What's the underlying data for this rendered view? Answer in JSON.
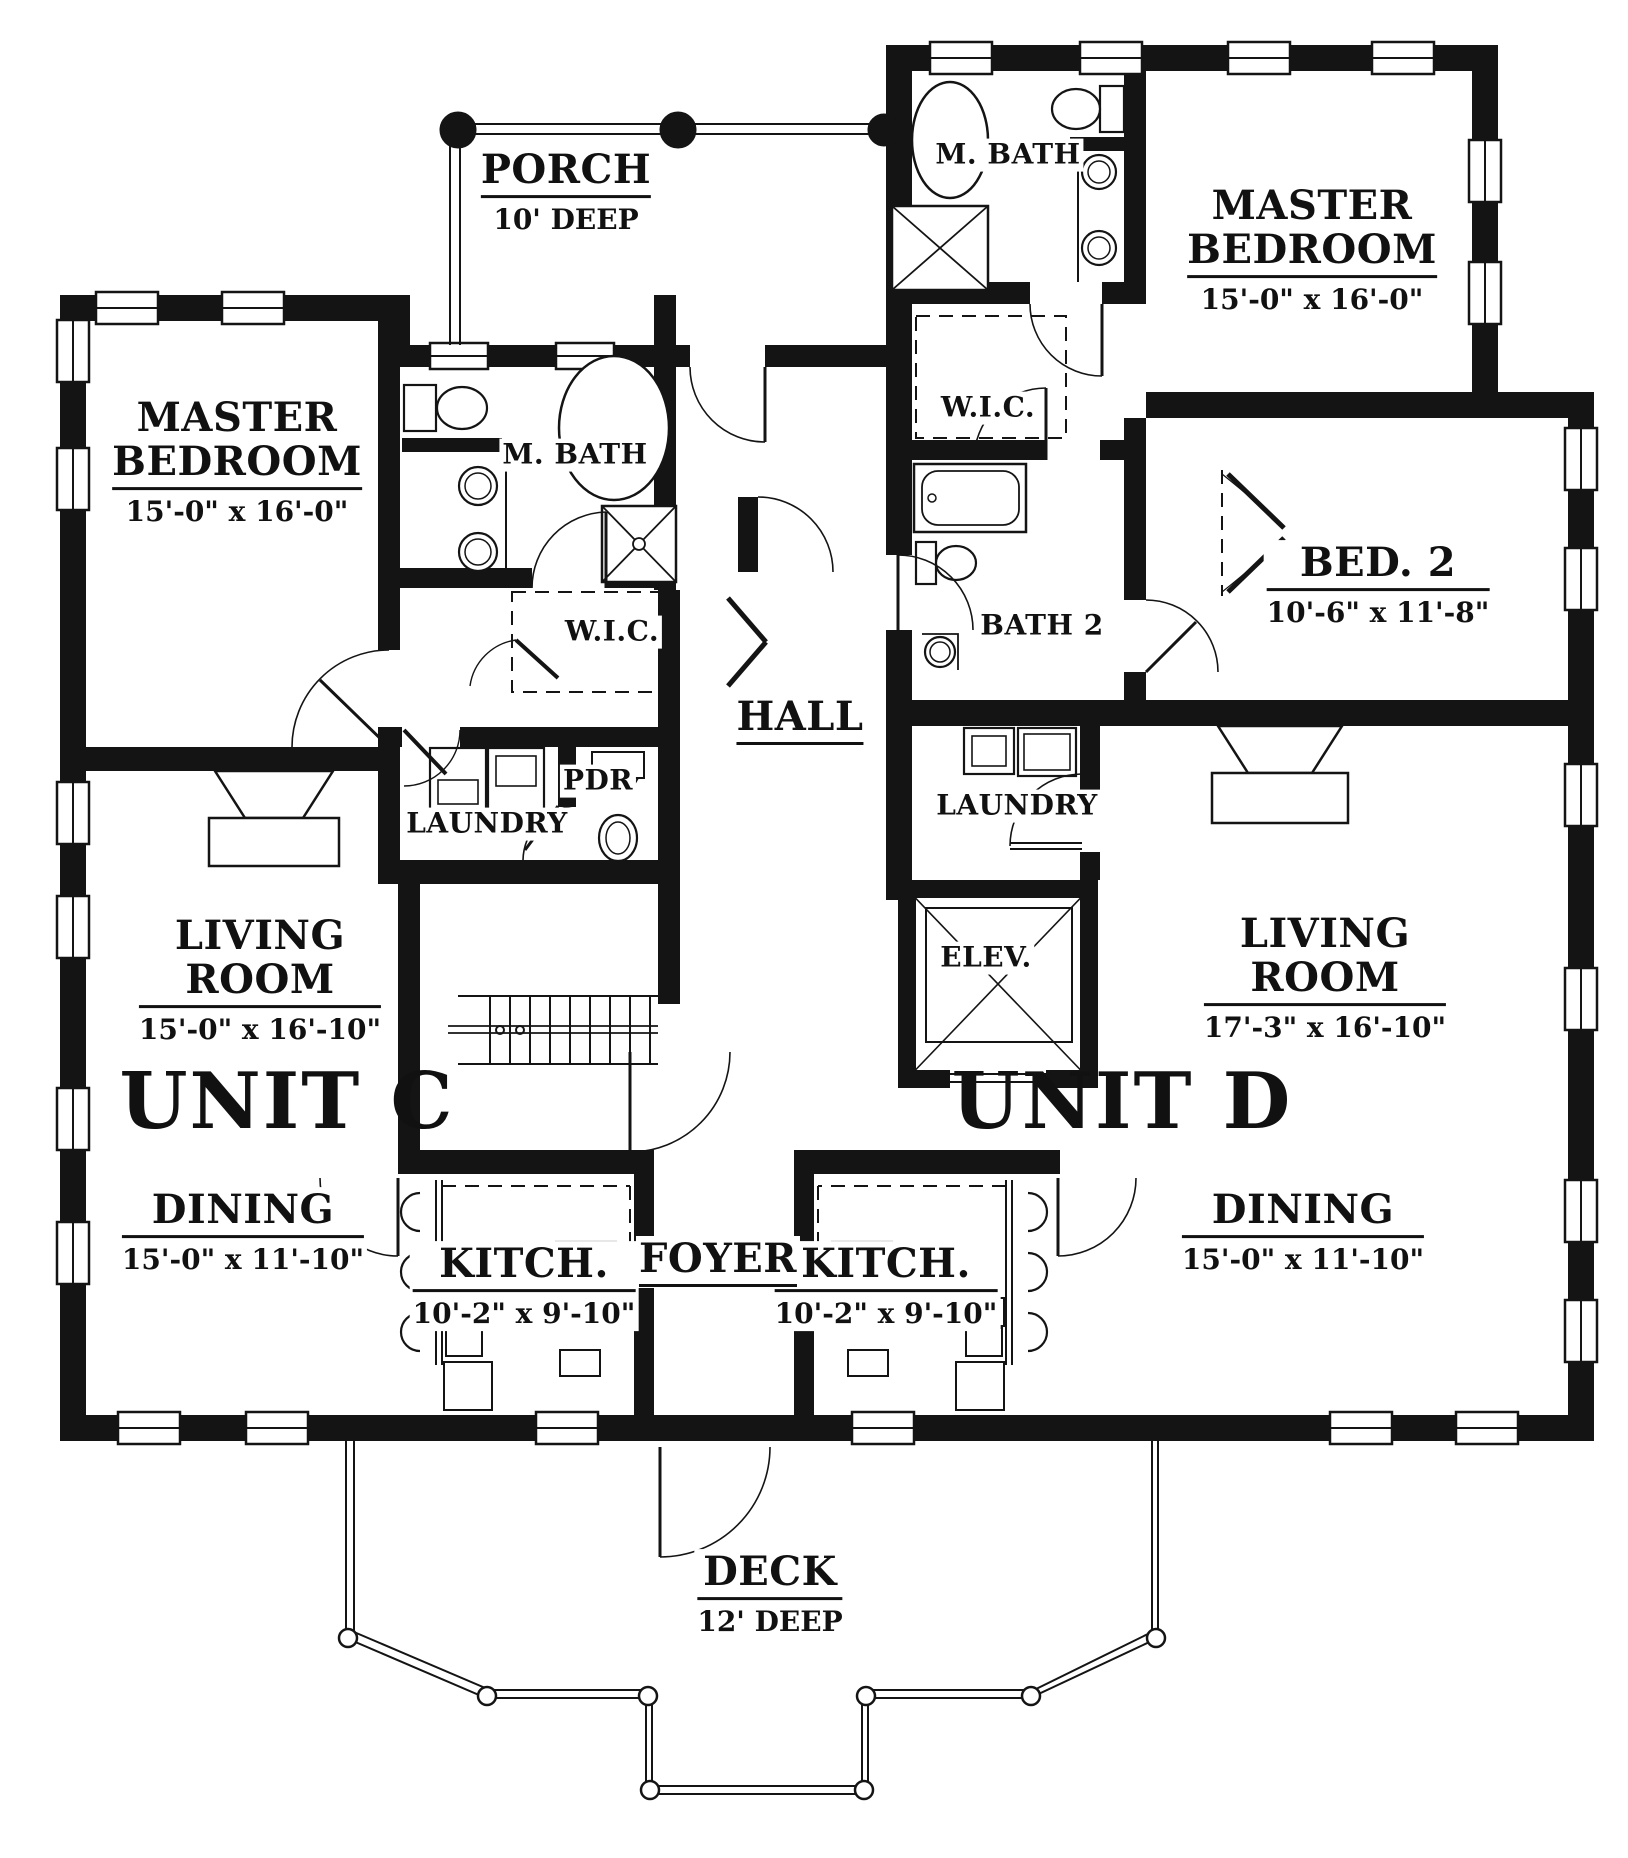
{
  "page": {
    "background": "#ffffff",
    "line_color": "#141414"
  },
  "rooms": {
    "porch": {
      "name": "PORCH",
      "dims": "10' DEEP"
    },
    "master_c": {
      "name_line1": "MASTER",
      "name_line2": "BEDROOM",
      "dims": "15'-0\" x 16'-0\""
    },
    "mbath_c": {
      "name": "M. BATH"
    },
    "wic_c": {
      "name": "W.I.C."
    },
    "pdr": {
      "name": "PDR"
    },
    "laundry_c": {
      "name": "LAUNDRY"
    },
    "hall": {
      "name": "HALL"
    },
    "living_c": {
      "name_line1": "LIVING",
      "name_line2": "ROOM",
      "dims": "15'-0\" x 16'-10\""
    },
    "unit_c": {
      "name": "UNIT C"
    },
    "dining_c": {
      "name": "DINING",
      "dims": "15'-0\" x 11'-10\""
    },
    "kitch_c": {
      "name": "KITCH.",
      "dims": "10'-2\" x 9'-10\""
    },
    "foyer": {
      "name": "FOYER"
    },
    "elev": {
      "name": "ELEV."
    },
    "deck": {
      "name": "DECK",
      "dims": "12' DEEP"
    },
    "master_d": {
      "name_line1": "MASTER",
      "name_line2": "BEDROOM",
      "dims": "15'-0\" x 16'-0\""
    },
    "mbath_d": {
      "name": "M. BATH"
    },
    "wic_d": {
      "name": "W.I.C."
    },
    "bed2": {
      "name": "BED. 2",
      "dims": "10'-6\" x 11'-8\""
    },
    "bath2": {
      "name": "BATH 2"
    },
    "laundry_d": {
      "name": "LAUNDRY"
    },
    "living_d": {
      "name_line1": "LIVING",
      "name_line2": "ROOM",
      "dims": "17'-3\" x 16'-10\""
    },
    "unit_d": {
      "name": "UNIT D"
    },
    "dining_d": {
      "name": "DINING",
      "dims": "15'-0\" x 11'-10\""
    },
    "kitch_d": {
      "name": "KITCH.",
      "dims": "10'-2\" x 9'-10\""
    }
  }
}
